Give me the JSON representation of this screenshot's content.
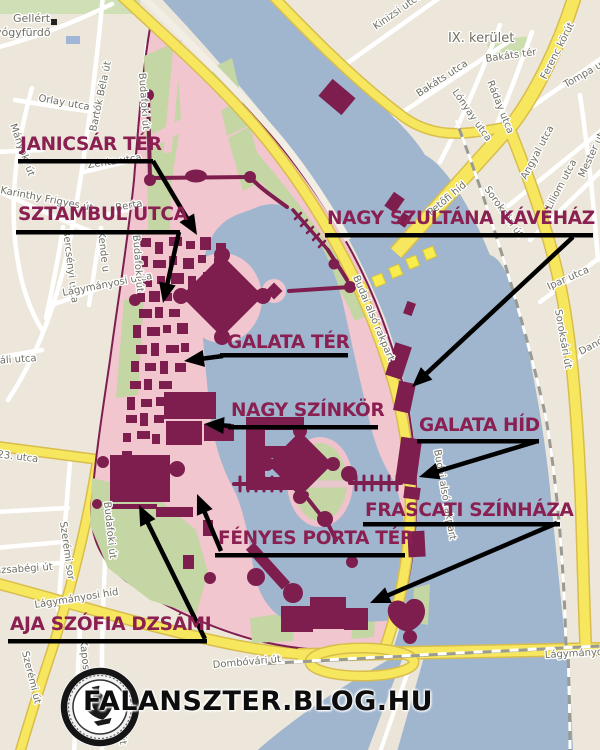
{
  "branding": {
    "watermark": "FALANSZTER.BLOG.HU",
    "logo": "falanszter-seal"
  },
  "colors": {
    "annotation_text": "#8A1F52",
    "buildings": "#7E1E4F",
    "water": "#9FB6CE",
    "district_pink": "#F1C6CF",
    "park_green": "#C3D6A4",
    "road_yellow": "#F7E75F",
    "arrow_black": "#000000"
  },
  "annotations": [
    {
      "id": "janicsar-ter",
      "label": "JANICSÁR TÉR",
      "x": 20,
      "y": 136,
      "ul": {
        "x1": 18,
        "x2": 153,
        "y": 159
      },
      "arrow": {
        "x1": 153,
        "y1": 161,
        "x2": 197,
        "y2": 235
      }
    },
    {
      "id": "sztambul-utca",
      "label": "SZTAMBUL UTCA",
      "x": 18,
      "y": 206,
      "ul": {
        "x1": 16,
        "x2": 180,
        "y": 230
      },
      "arrow": {
        "x1": 179,
        "y1": 232,
        "x2": 163,
        "y2": 303
      }
    },
    {
      "id": "nagy-szultana-kavehaz",
      "label": "NAGY SZULTÁNA KÁVÉHÁZ",
      "x": 327,
      "y": 210,
      "ul": {
        "x1": 325,
        "x2": 593,
        "y": 233
      },
      "arrow": {
        "x1": 573,
        "y1": 237,
        "x2": 412,
        "y2": 387
      }
    },
    {
      "id": "galata-ter",
      "label": "GALATA TÉR",
      "x": 227,
      "y": 334,
      "ul": {
        "x1": 220,
        "x2": 348,
        "y": 353
      },
      "arrow": {
        "x1": 223,
        "y1": 356,
        "x2": 184,
        "y2": 361
      }
    },
    {
      "id": "nagy-szinkor",
      "label": "NAGY SZÍNKÖR",
      "x": 231,
      "y": 402,
      "ul": {
        "x1": 228,
        "x2": 378,
        "y": 425
      },
      "arrow": {
        "x1": 231,
        "y1": 426,
        "x2": 204,
        "y2": 424
      }
    },
    {
      "id": "galata-hid",
      "label": "GALATA HÍD",
      "x": 419,
      "y": 417,
      "ul": {
        "x1": 417,
        "x2": 539,
        "y": 439
      },
      "arrow": {
        "x1": 538,
        "y1": 441,
        "x2": 419,
        "y2": 477
      }
    },
    {
      "id": "frascati-szinhaza",
      "label": "FRASCATI SZÍNHÁZA",
      "x": 365,
      "y": 502,
      "ul": {
        "x1": 363,
        "x2": 560,
        "y": 522
      },
      "arrow": {
        "x1": 557,
        "y1": 523,
        "x2": 370,
        "y2": 603
      }
    },
    {
      "id": "fenyes-porta-ter",
      "label": "FÉNYES PORTA TÉR",
      "x": 218,
      "y": 530,
      "ul": {
        "x1": 215,
        "x2": 405,
        "y": 553
      },
      "arrow": {
        "x1": 221,
        "y1": 551,
        "x2": 197,
        "y2": 494
      }
    },
    {
      "id": "aja-szofia-dzsami",
      "label": "AJA SZÓFIA DZSÁMI",
      "x": 10,
      "y": 616,
      "ul": {
        "x1": 8,
        "x2": 207,
        "y": 639
      },
      "arrow": {
        "x1": 205,
        "y1": 639,
        "x2": 139,
        "y2": 505
      }
    }
  ],
  "street_labels": [
    {
      "t": "Gellért",
      "x": 13,
      "y": 22,
      "r": 0,
      "s": 11
    },
    {
      "t": "gyógyfürdő",
      "x": -12,
      "y": 36,
      "r": 0,
      "s": 11
    },
    {
      "t": "Orlay utca",
      "x": 38,
      "y": 101,
      "r": 10
    },
    {
      "t": "Bartók Béla út",
      "x": 96,
      "y": 132,
      "r": -78
    },
    {
      "t": "Budafoki út",
      "x": 139,
      "y": 73,
      "r": 86
    },
    {
      "t": "Zenta utca",
      "x": 88,
      "y": 168,
      "r": -8
    },
    {
      "t": "Berta",
      "x": 116,
      "y": 211,
      "r": -10
    },
    {
      "t": "Karinthy Frigyes út",
      "x": 0,
      "y": 193,
      "r": 11
    },
    {
      "t": "Mányoki út",
      "x": 10,
      "y": 125,
      "r": 70
    },
    {
      "t": "Bercsényi utca",
      "x": 63,
      "y": 230,
      "r": 83
    },
    {
      "t": "Kende u",
      "x": 98,
      "y": 232,
      "r": 83
    },
    {
      "t": "Lágymányosi utca",
      "x": 63,
      "y": 296,
      "r": -11
    },
    {
      "t": "Budafoki út",
      "x": 133,
      "y": 235,
      "r": 86
    },
    {
      "t": "Váli utca",
      "x": -6,
      "y": 364,
      "r": -4
    },
    {
      "t": "Október 23. utca",
      "x": -46,
      "y": 452,
      "r": 7
    },
    {
      "t": "Szerémi sor",
      "x": 60,
      "y": 522,
      "r": 82
    },
    {
      "t": "Hamzsabégi út",
      "x": -22,
      "y": 575,
      "r": -4
    },
    {
      "t": "Lágymányosi híd",
      "x": 35,
      "y": 608,
      "r": -9
    },
    {
      "t": "Szerémi út",
      "x": 22,
      "y": 652,
      "r": 76
    },
    {
      "t": "Kaposvári u",
      "x": 80,
      "y": 640,
      "r": 84
    },
    {
      "t": "Budafoki út",
      "x": 104,
      "y": 502,
      "r": 84
    },
    {
      "t": "Budafoki út",
      "x": 114,
      "y": 688,
      "r": 84
    },
    {
      "t": "Dombóvári út",
      "x": 213,
      "y": 668,
      "r": -5
    },
    {
      "t": "IX. kerület",
      "x": 448,
      "y": 42,
      "r": 0,
      "s": 13
    },
    {
      "t": "Kinizsi utca",
      "x": 376,
      "y": 30,
      "r": -35
    },
    {
      "t": "Bakáts utca",
      "x": 419,
      "y": 97,
      "r": -33
    },
    {
      "t": "Bakáts tér",
      "x": 486,
      "y": 62,
      "r": -8
    },
    {
      "t": "Ráday utca",
      "x": 487,
      "y": 82,
      "r": 68
    },
    {
      "t": "Lónyay utca",
      "x": 452,
      "y": 92,
      "r": 55
    },
    {
      "t": "Ferenc körút",
      "x": 546,
      "y": 80,
      "r": -63
    },
    {
      "t": "Tompa utca",
      "x": 566,
      "y": 88,
      "r": -30
    },
    {
      "t": "Angyal utca",
      "x": 526,
      "y": 180,
      "r": -62
    },
    {
      "t": "Liliom utca",
      "x": 551,
      "y": 210,
      "r": -62
    },
    {
      "t": "Mester utca",
      "x": 584,
      "y": 178,
      "r": -65
    },
    {
      "t": "Petőfi híd",
      "x": 431,
      "y": 216,
      "r": -40
    },
    {
      "t": "Soroksári út",
      "x": 484,
      "y": 189,
      "r": 55
    },
    {
      "t": "Soroksári út",
      "x": 555,
      "y": 310,
      "r": 80
    },
    {
      "t": "Ipar utca",
      "x": 549,
      "y": 290,
      "r": -24
    },
    {
      "t": "Dandár utca",
      "x": 581,
      "y": 355,
      "r": -28
    },
    {
      "t": "Budai alsó rakpart",
      "x": 353,
      "y": 277,
      "r": 67
    },
    {
      "t": "Budai alsó rakpart",
      "x": 434,
      "y": 450,
      "r": 80
    },
    {
      "t": "Lágymányosi híd",
      "x": 545,
      "y": 658,
      "r": -3
    }
  ]
}
